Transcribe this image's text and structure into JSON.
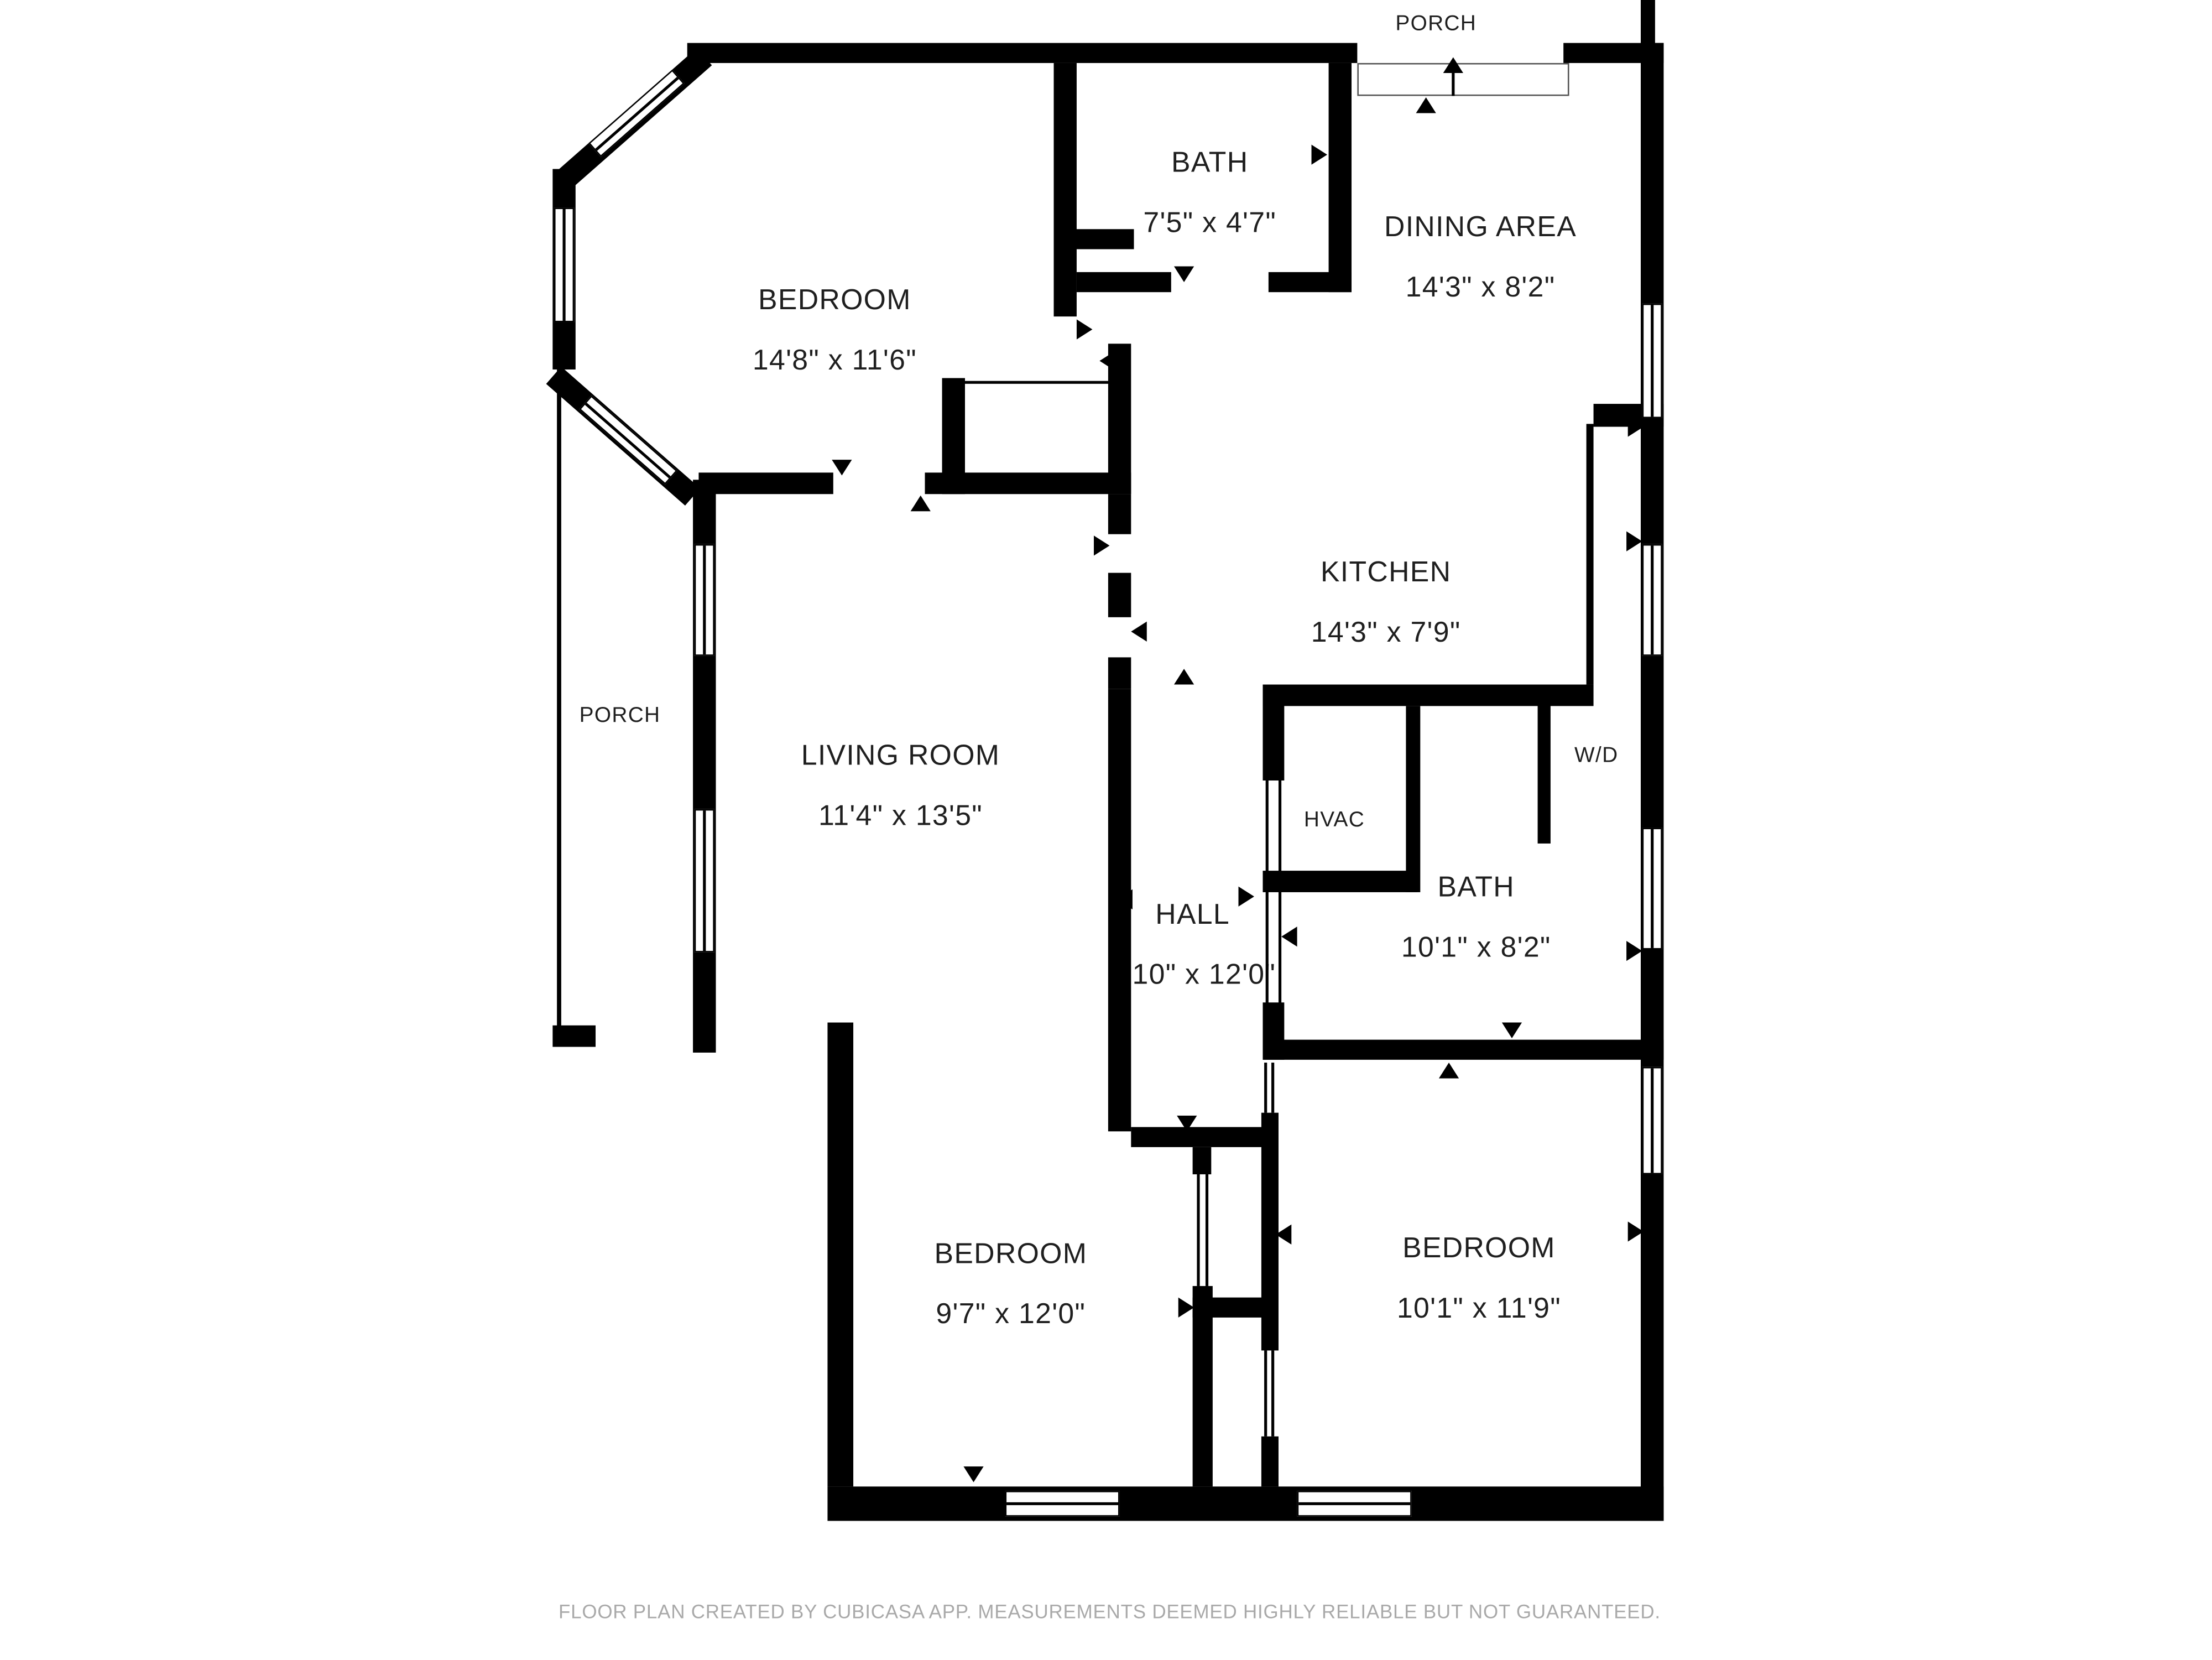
{
  "title": "Floor plan",
  "colors": {
    "wall": "#000000",
    "text": "#1f1f1f",
    "footer_text": "#a9a9a9",
    "background": "#ffffff"
  },
  "rooms": [
    {
      "name": "BATH",
      "dims": "7'5\" x 4'7\""
    },
    {
      "name": "DINING AREA",
      "dims": "14'3\" x 8'2\""
    },
    {
      "name": "BEDROOM",
      "dims": "14'8\" x 11'6\""
    },
    {
      "name": "KITCHEN",
      "dims": "14'3\" x 7'9\""
    },
    {
      "name": "LIVING ROOM",
      "dims": "11'4\" x 13'5\""
    },
    {
      "name": "BATH",
      "dims": "10'1\" x 8'2\""
    },
    {
      "name": "HALL",
      "dims": "3'10\" x 12'0\""
    },
    {
      "name": "BEDROOM",
      "dims": "9'7\" x 12'0\""
    },
    {
      "name": "BEDROOM",
      "dims": "10'1\" x 11'9\""
    }
  ],
  "labels": {
    "porch_top": "PORCH",
    "porch_left": "PORCH",
    "hvac": "HVAC",
    "wd": "W/D"
  },
  "footer": "FLOOR PLAN CREATED BY CUBICASA APP. MEASUREMENTS DEEMED HIGHLY RELIABLE BUT NOT GUARANTEED."
}
